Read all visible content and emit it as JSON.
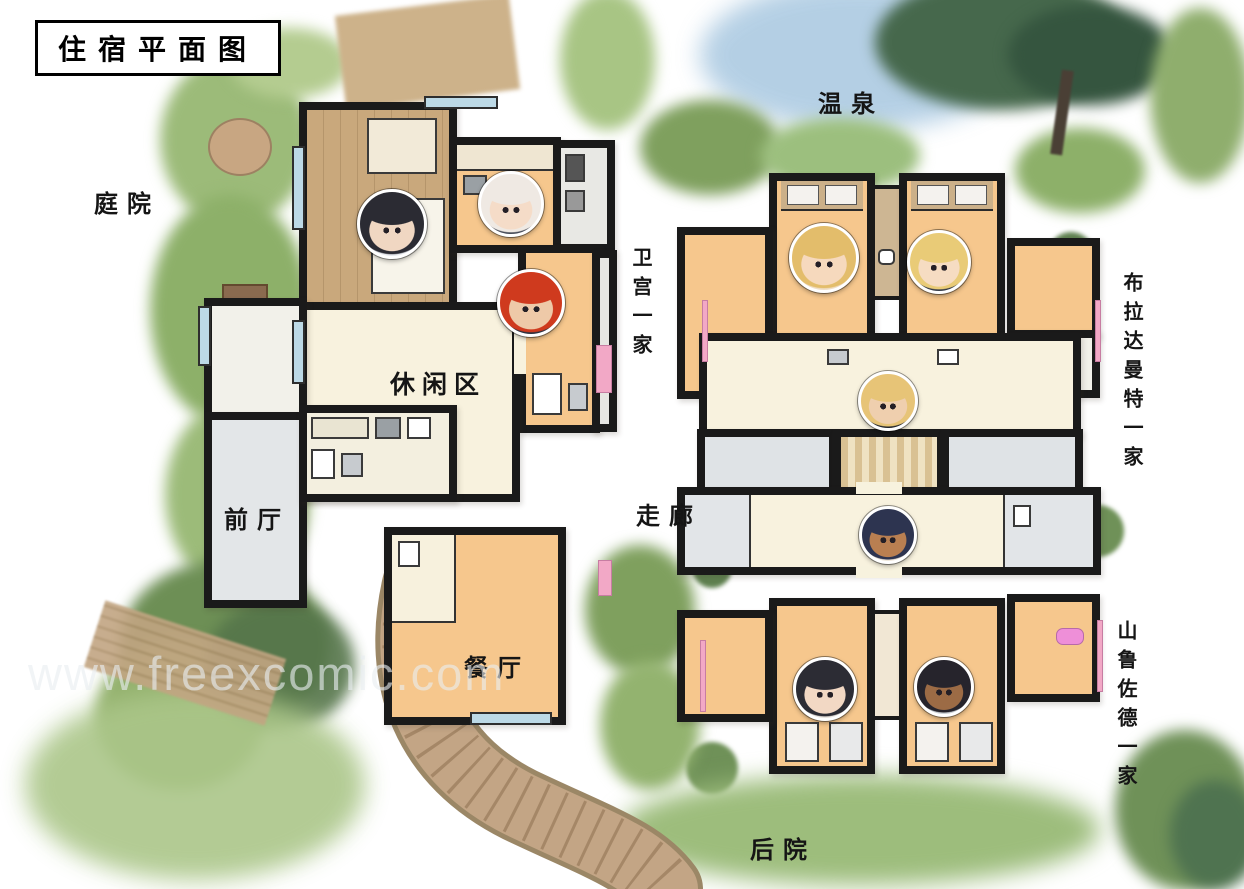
{
  "title": "住宿平面图",
  "watermark": "www.freexcomic.com",
  "areas": {
    "courtyard": "庭院",
    "hot_spring": "温泉",
    "leisure": "休闲区",
    "front_hall": "前厅",
    "corridor": "走廊",
    "dining": "餐厅",
    "backyard": "后院"
  },
  "families": {
    "emiya": "卫宫一家",
    "bradamante": "布拉达曼特一家",
    "scheherazade": "山鲁佐德一家"
  },
  "colors": {
    "wall": "#1a1a1a",
    "room_peach": "#f6c78d",
    "room_cream": "#f8f2de",
    "room_white": "#f2f1ea",
    "room_gray": "#dfe3e6",
    "wood_floor": "#c9a87c",
    "window_blue": "#bcd9e6",
    "grass_light": "#a6c284",
    "grass_mid": "#7fa05e",
    "grass_dark": "#55754a",
    "sky_blue": "#b8d2e5",
    "path_tan": "#c3a585",
    "accent_pink": "#f2a8c6"
  },
  "avatars": [
    {
      "name": "black-haired-man",
      "family": "emiya",
      "hair": "#2b2b33",
      "skin": "#f0d7c2",
      "bg": "#e7e9ee",
      "x": 389,
      "y": 221,
      "d": 64
    },
    {
      "name": "white-haired-woman",
      "family": "emiya",
      "hair": "#efe9e3",
      "skin": "#f5dcc8",
      "bg": "#474c58",
      "x": 508,
      "y": 201,
      "d": 60
    },
    {
      "name": "red-haired-boy",
      "family": "emiya",
      "hair": "#cf3a1e",
      "skin": "#eec9a8",
      "bg": "#2c3140",
      "x": 528,
      "y": 300,
      "d": 62
    },
    {
      "name": "blonde-woman-wavy",
      "family": "bradamante",
      "hair": "#e3bd6b",
      "skin": "#f6d9bd",
      "bg": "#f0dfc8",
      "x": 821,
      "y": 255,
      "d": 64
    },
    {
      "name": "blonde-woman-crown",
      "family": "bradamante",
      "hair": "#e9cb77",
      "skin": "#f6dcc2",
      "bg": "#343a46",
      "x": 936,
      "y": 259,
      "d": 58
    },
    {
      "name": "blonde-child",
      "family": "bradamante",
      "hair": "#e7c477",
      "skin": "#efcfae",
      "bg": "#23262d",
      "x": 885,
      "y": 398,
      "d": 54
    },
    {
      "name": "dark-skinned-woman-gold-headdress",
      "family": "scheherazade",
      "hair": "#2d3450",
      "skin": "#b97f51",
      "bg": "#efe7da",
      "x": 885,
      "y": 532,
      "d": 52
    },
    {
      "name": "black-haired-teen",
      "family": "scheherazade",
      "hair": "#2c2c34",
      "skin": "#f2d8c4",
      "bg": "#e9e4df",
      "x": 822,
      "y": 686,
      "d": 58
    },
    {
      "name": "dark-skinned-child",
      "family": "scheherazade",
      "hair": "#26242c",
      "skin": "#9c6b45",
      "bg": "#cdd2d6",
      "x": 941,
      "y": 684,
      "d": 54
    }
  ]
}
